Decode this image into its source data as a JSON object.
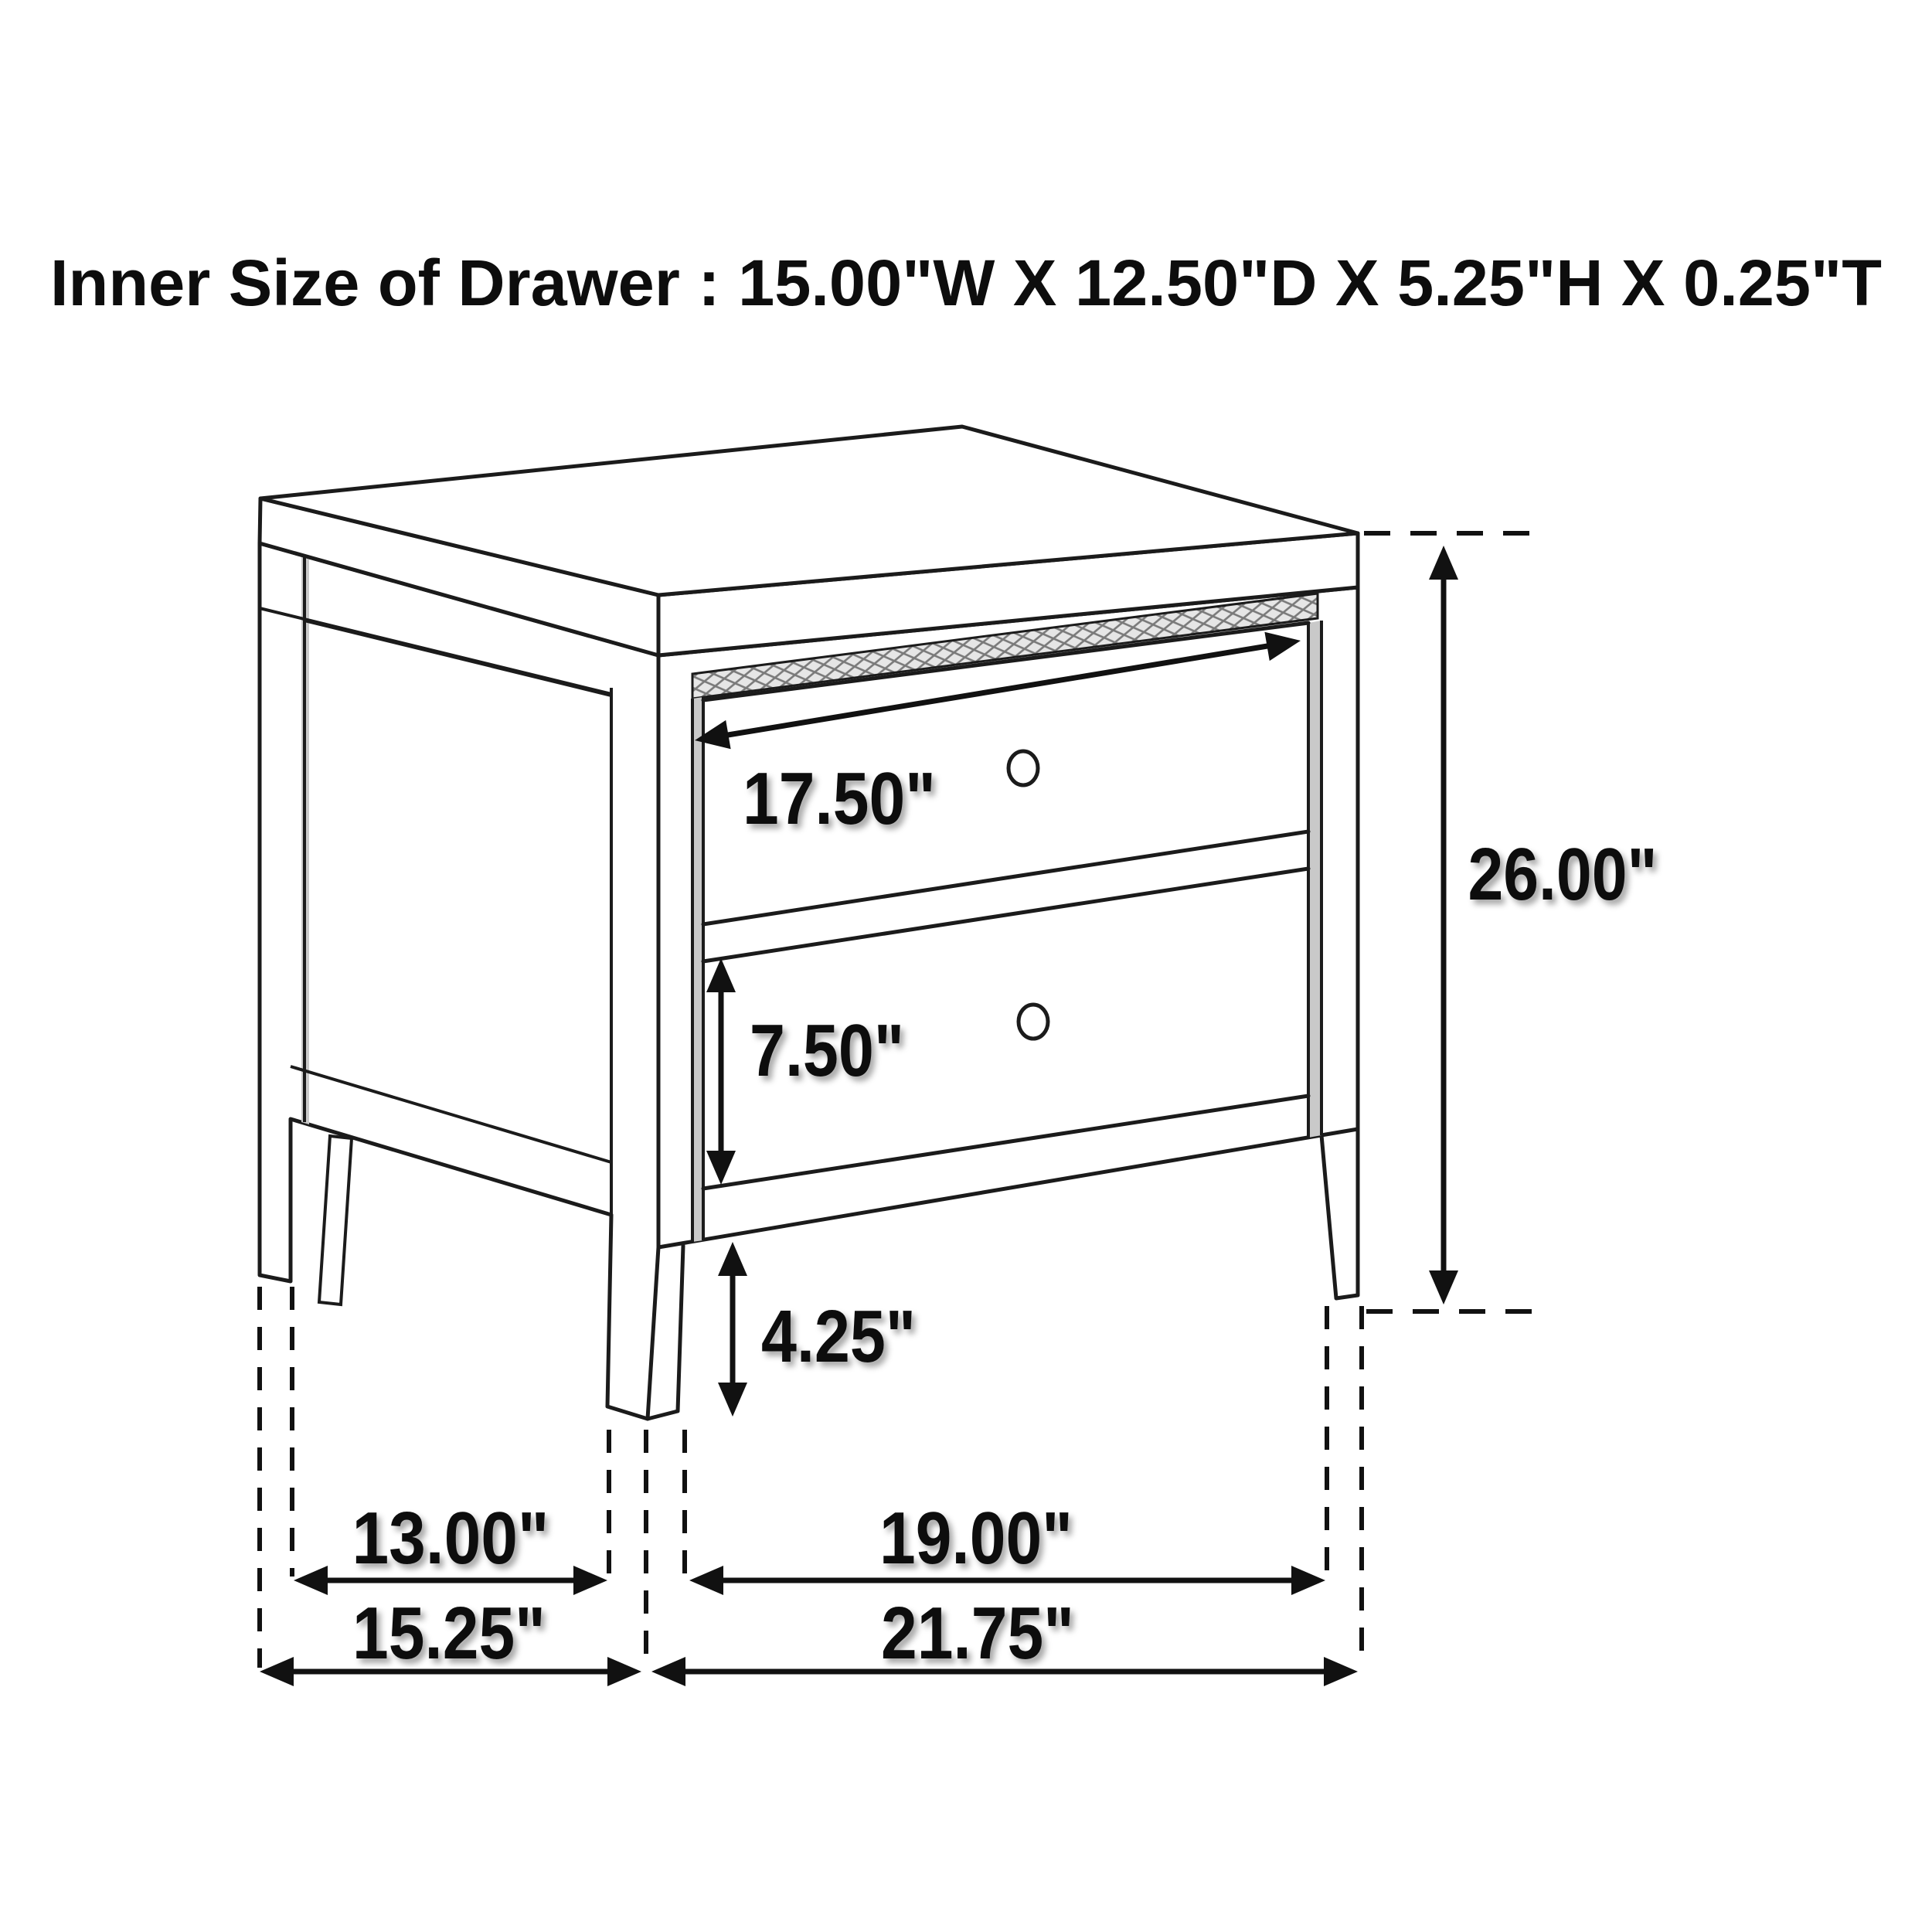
{
  "title": "Inner Size of Drawer : 15.00\"W X 12.50\"D X 5.25\"H X 0.25\"T",
  "diagram": {
    "type": "furniture-dimension-line-drawing",
    "subject": "two-drawer nightstand, three-quarter view"
  },
  "dims": [
    {
      "name": "drawer-face-width",
      "label": "17.50\""
    },
    {
      "name": "overall-height",
      "label": "26.00\""
    },
    {
      "name": "bottom-drawer-face-height",
      "label": "7.50\""
    },
    {
      "name": "leg-height",
      "label": "4.25\""
    },
    {
      "name": "side-leg-spacing",
      "label": "13.00\""
    },
    {
      "name": "front-leg-spacing",
      "label": "19.00\""
    },
    {
      "name": "overall-depth",
      "label": "15.25\""
    },
    {
      "name": "overall-width",
      "label": "21.75\""
    }
  ],
  "colors": {
    "line": "#1b1b1b",
    "dimension": "#111111",
    "background": "#ffffff",
    "shading": "#c9c9c9",
    "hatch": "#7a7a7a"
  }
}
